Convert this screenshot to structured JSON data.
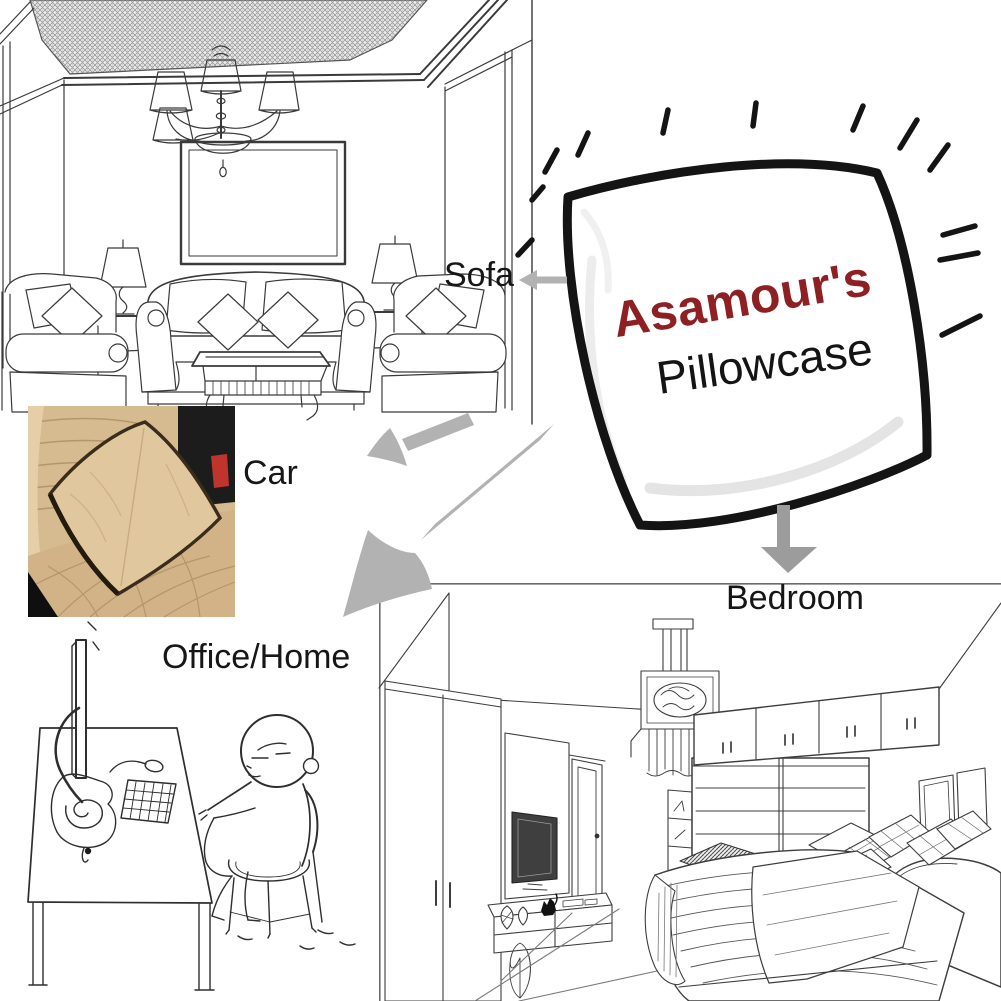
{
  "product": {
    "brand": "Asamour's",
    "name": "Pillowcase"
  },
  "use_case_labels": {
    "sofa": "Sofa",
    "car": "Car",
    "office_home": "Office/Home",
    "bedroom": "Bedroom"
  },
  "colors": {
    "background": "#ffffff",
    "brand_text": "#8e1f22",
    "product_text": "#141414",
    "label_text": "#161616",
    "arrow_gray": "#b2b2b2",
    "arrow_gray_dark": "#9c9c9c",
    "line_art": "#333333",
    "pillow_outline": "#141414",
    "car_seat_beige": "#d7bb90",
    "car_pillow_beige": "#e0c79e",
    "car_console_black": "#1c1c1c",
    "car_seatbelt_red": "#c0342e"
  },
  "illustrations": {
    "living_room": "line drawing of living room with chandelier, wall picture, sofa set and lamps",
    "pillow": "hand-drawn pillow with radiating emphasis dashes",
    "car_seat_photo": "photo of beige pillow resting on leather car seat",
    "office_home": "cartoon of person slouching on chair at computer desk",
    "bedroom": "line drawing of bedroom with wardrobe, TV, closet and bed"
  }
}
